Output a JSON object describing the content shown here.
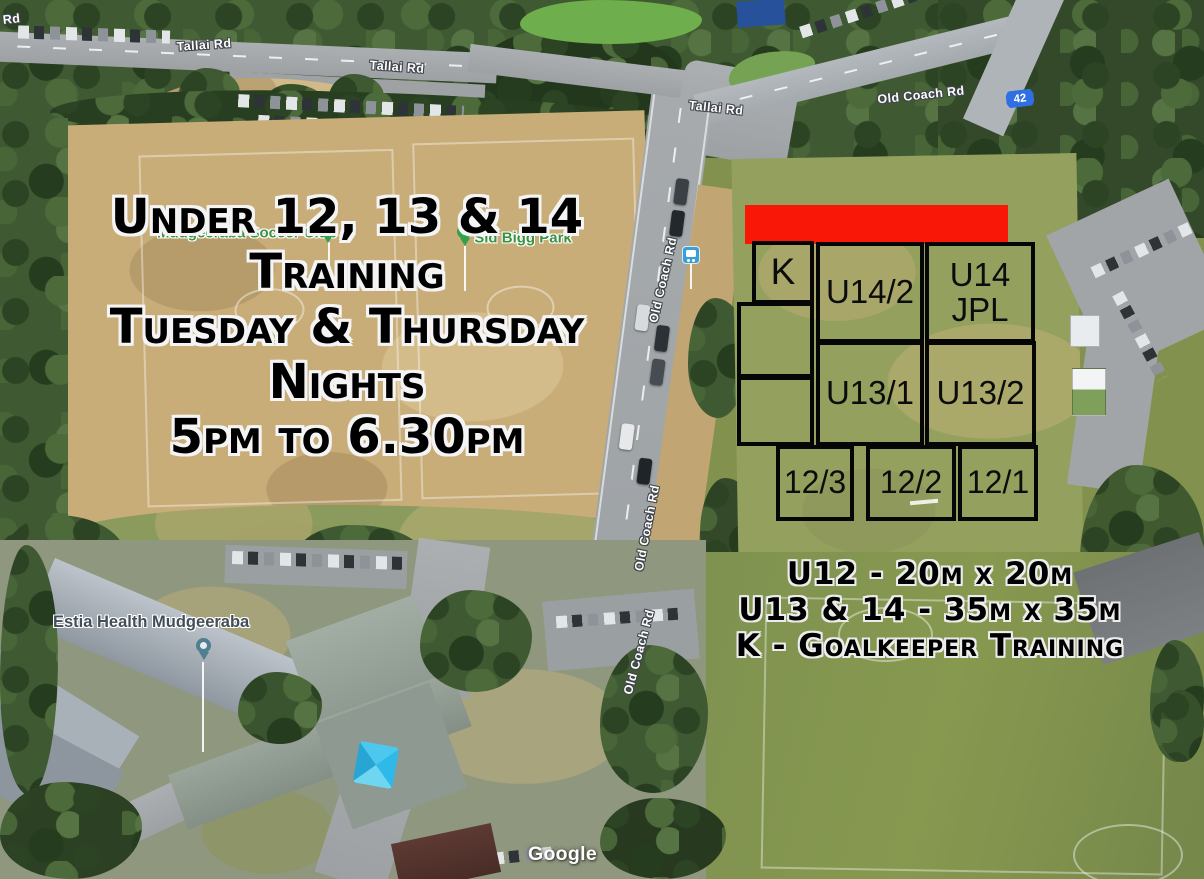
{
  "map_overlay": {
    "title_lines": [
      "Under 12, 13 & 14",
      "Training",
      "Tuesday & Thursday",
      "Nights",
      "5pm to 6.30pm"
    ],
    "legend_lines": [
      "U12 - 20m x 20m",
      "U13 & 14 - 35m x 35m",
      "K - Goalkeeper Training"
    ],
    "highlight_color": "#f91708"
  },
  "training_grid": {
    "border_color": "#060606",
    "zones": [
      {
        "id": "k",
        "label": "K"
      },
      {
        "id": "u14-2",
        "label": "U14/2"
      },
      {
        "id": "u14-jpl",
        "label": "U14",
        "label2": "JPL"
      },
      {
        "id": "u13-1",
        "label": "U13/1"
      },
      {
        "id": "u13-2",
        "label": "U13/2"
      },
      {
        "id": "12-3",
        "label": "12/3"
      },
      {
        "id": "12-2",
        "label": "12/2"
      },
      {
        "id": "12-1",
        "label": "12/1"
      }
    ]
  },
  "map_labels": {
    "roads": [
      {
        "text": "Tallai Rd"
      },
      {
        "text": "Tallai Rd"
      },
      {
        "text": "Tallai Rd"
      },
      {
        "text": "Tallai Rd"
      },
      {
        "text": "Old Coach Rd"
      },
      {
        "text": "Old Coach Rd"
      },
      {
        "text": "Old Coach Rd"
      },
      {
        "text": "Old Coach Rd"
      }
    ],
    "places": [
      {
        "text": "Mudgeeraba Soccer Club",
        "pin_color": "#33a14b"
      },
      {
        "text": "Sid Bigg Park",
        "pin_color": "#33a14b"
      },
      {
        "text": "Estia Health Mudgeeraba",
        "pin_color": "#4f7f90"
      }
    ],
    "route_shield": {
      "number": "42",
      "color": "#2f6fe3"
    },
    "bus_stop_icon_color": "#38a0d8",
    "watermark": "Google"
  }
}
